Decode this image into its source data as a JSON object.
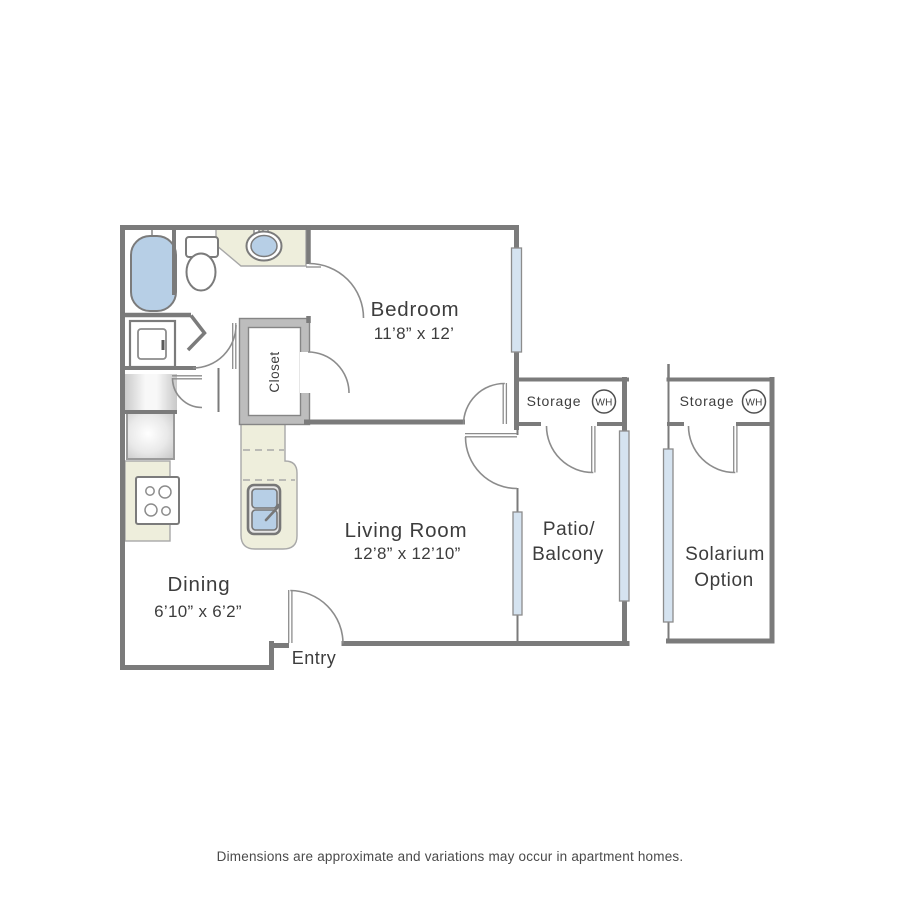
{
  "colors": {
    "wall": "#7b7b7b",
    "line": "#8c8c8c",
    "ink": "#3d3d3d",
    "windowFill": "#d5e3f0",
    "blue": "#b7cfe6",
    "beige": "#eeeedc",
    "beigeEdge": "#a8a8a8",
    "poche": "#bdbdbd",
    "pocheEdge": "#858585",
    "caption": "#4a4a4a"
  },
  "plan": {
    "bedroom": {
      "name": "Bedroom",
      "dims": "11’8” x 12’"
    },
    "living_room": {
      "name": "Living Room",
      "dims": "12’8” x 12’10”"
    },
    "dining": {
      "name": "Dining",
      "dims": "6’10” x 6’2”"
    },
    "patio": {
      "line1": "Patio/",
      "line2": "Balcony"
    },
    "solarium": {
      "line1": "Solarium",
      "line2": "Option"
    },
    "storage_left": {
      "label": "Storage",
      "water_heater": "WH"
    },
    "storage_right": {
      "label": "Storage",
      "water_heater": "WH"
    },
    "closet": {
      "label": "Closet"
    },
    "entry": {
      "label": "Entry"
    }
  },
  "footer": {
    "disclaimer": "Dimensions are approximate and variations may occur in apartment homes."
  }
}
